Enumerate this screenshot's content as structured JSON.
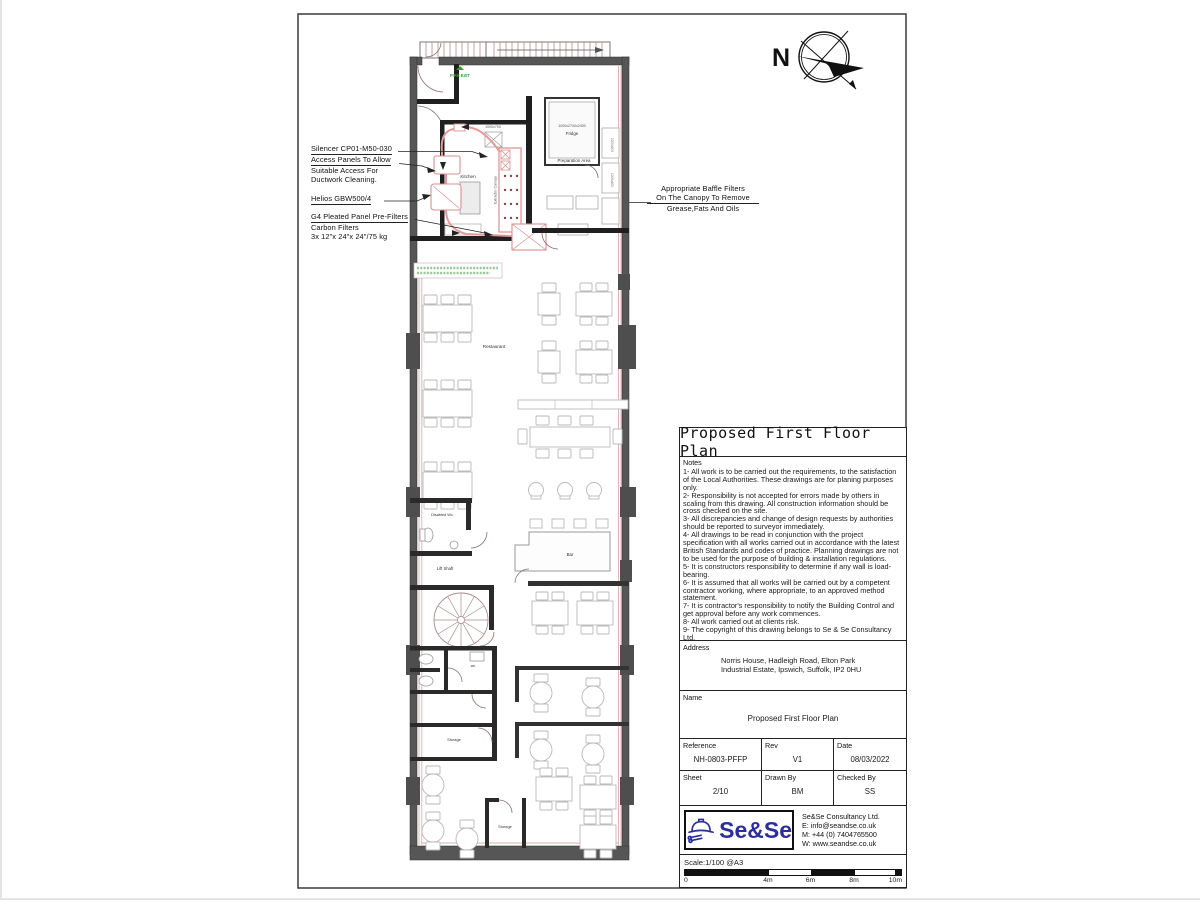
{
  "sheet": {
    "compass_label": "N"
  },
  "annotations": {
    "left": [
      {
        "lines": [
          "Silencer CP01-M50-030"
        ]
      },
      {
        "lines": [
          "Access Panels To Allow",
          "Suitable Access For",
          "Ductwork Cleaning."
        ]
      },
      {
        "lines": [
          "Helios GBW500/4"
        ]
      },
      {
        "lines": [
          "G4 Pleated Panel Pre-Filters",
          "Carbon Filters",
          "3x 12\"x 24\"x 24\"/75 kg"
        ]
      }
    ],
    "right": {
      "lines": [
        "Appropriate Baffle Filters",
        "On The Canopy To Remove",
        "Grease,Fats And Oils"
      ]
    }
  },
  "plan": {
    "rooms": {
      "kitchen": "Kitchen",
      "preparation": "Preparation Area",
      "fridge": "Fridge",
      "fridge_dims": "1000x2700x2400",
      "kitchen_dims": "1000x700",
      "restaurant": "Restaurant",
      "disabled_wc": "Disabled Wc",
      "lift_shaft": "Lift Shaft",
      "bar": "Bar",
      "wc": "wc",
      "storage1": "Storage",
      "storage2": "Storage",
      "extractor": "Extractor Canopy",
      "fire_exit": "FIRE EXIT",
      "shelf_dim1": "1200x600",
      "shelf_dim2": "1200x600"
    }
  },
  "titleblock": {
    "title": "Proposed First Floor Plan",
    "notes_header": "Notes",
    "notes": [
      "1- All work is to be carried out the requirements, to the satisfaction of the Local Authorities. These drawings are for planing purposes only.",
      "2- Responsibility is not accepted for errors made by others in scaling from this drawing. All construction information should be cross checked on the site.",
      "3- All discrepancies and change of design requests by authorities should be reported to surveyor immediately.",
      "4- All drawings to be read in conjunction with the project specification with all works carried out in accordance with the latest British Standards and codes of practice. Planning drawings are not to be used for the purpose of building & installation regulations.",
      "5- It is constructors responsibility to determine if any wall is load-bearing.",
      "6- It is assumed that all works will be carried out by a competent contractor working, where appropriate, to an approved method statement.",
      "7- It is contractor's responsibility to notify the Building Control and get approval before any work commences.",
      "8- All work carried out at clients risk.",
      "9- The copyright of this drawing belongs to Se & Se Consultancy Ltd."
    ],
    "address_label": "Address",
    "address": "Norris House, Hadleigh Road, Elton Park Industrial Estate, Ipswich, Suffolk, IP2 0HU",
    "name_label": "Name",
    "name_value": "Proposed First Floor Plan",
    "fields": {
      "reference_label": "Reference",
      "reference": "NH-0803-PFFP",
      "rev_label": "Rev",
      "rev": "V1",
      "date_label": "Date",
      "date": "08/03/2022",
      "sheet_label": "Sheet",
      "sheet": "2/10",
      "drawn_label": "Drawn By",
      "drawn": "BM",
      "checked_label": "Checked By",
      "checked": "SS"
    },
    "logo": {
      "text": "Se&Se"
    },
    "company": {
      "lines": [
        "Se&Se Consultancy Ltd.",
        "E: info@seandse.co.uk",
        "M: +44 (0) 7404765500",
        "W: www.seandse.co.uk"
      ]
    },
    "scale_text": "Scale:1/100 @A3",
    "scale_ticks": [
      "0",
      "4m",
      "6m",
      "8m",
      "10m"
    ]
  },
  "colors": {
    "duct_red": "#e59a9a",
    "wall_gray": "#565656",
    "logo_navy": "#2b2f9e",
    "fire_exit_green": "#2f9e2f"
  }
}
